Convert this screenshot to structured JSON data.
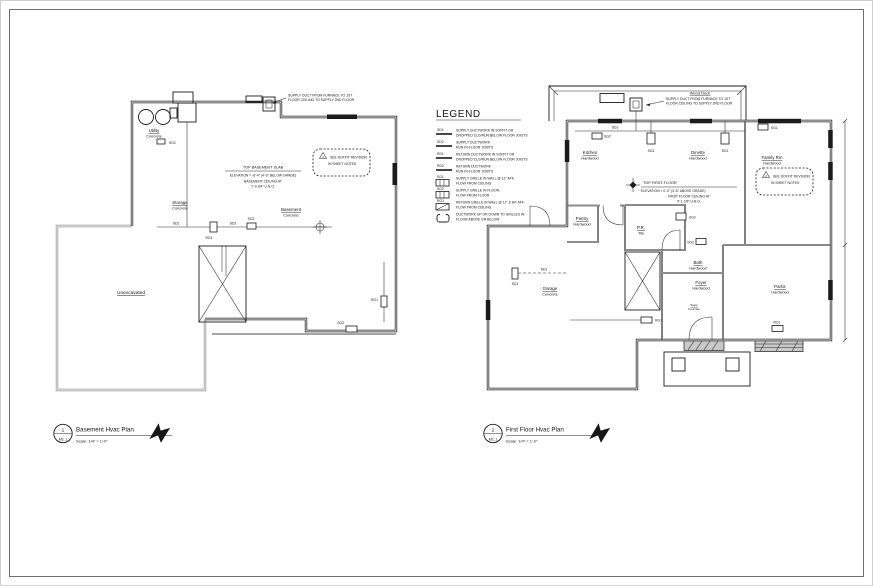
{
  "sheet": {
    "paper_color": "#ffffff",
    "line_color": "#1b1b1b",
    "gray_line_color": "#8f8f8f"
  },
  "legend": {
    "title": "LEGEND",
    "items": [
      {
        "tag": "SD1",
        "desc1": "SUPPLY DUCTWORK IN SOFFIT OR",
        "desc2": "DROPPED CLG/RUN BELOW FLOOR JOISTS"
      },
      {
        "tag": "SD2",
        "desc1": "SUPPLY DUCTWORK",
        "desc2": "RUN IN FLOOR JOISTS"
      },
      {
        "tag": "RD1",
        "desc1": "RETURN DUCTWORK IN SOFFIT OR",
        "desc2": "DROPPED CLG/RUN BELOW FLOOR JOISTS"
      },
      {
        "tag": "RD2",
        "desc1": "RETURN DUCTWORK",
        "desc2": "RUN IN FLOOR JOISTS"
      },
      {
        "tag": "SG1",
        "desc1": "SUPPLY GRILLE IN WALL @ 12\" AFF,",
        "desc2": "FLOW FROM CEILING"
      },
      {
        "tag": "SG2",
        "desc1": "SUPPLY GRILLE IN FLOOR,",
        "desc2": "FLOW FROM FLOOR"
      },
      {
        "tag": "RG1",
        "desc1": "RETURN GRILLE IN WALL @ 12\" & 84\" AFF,",
        "desc2": "FLOW FROM CEILING"
      },
      {
        "tag": "",
        "desc1": "DUCTWORK UP OR DOWN TO GRILLES IN",
        "desc2": "FLOOR ABOVE OR BELOW"
      }
    ]
  },
  "basement_plan": {
    "callout": {
      "number": "1",
      "sheet": "M1.1"
    },
    "title": "Basement Hvac Plan",
    "scale": "Scale: 1/4\" = 1'-0\"",
    "rooms": {
      "utility": {
        "name": "Utility",
        "floor": "Concrete"
      },
      "storage": {
        "name": "Storage",
        "floor": "Concrete"
      },
      "basement": {
        "name": "Basement",
        "floor": "Concrete"
      },
      "unexcavated": {
        "name": "Unexcavated"
      }
    },
    "supply_note": {
      "line1": "SUPPLY DUCT FROM FURNACE TO 1ST",
      "line2": "FLOOR CEILING TO SUPPLY 2ND FLOOR"
    },
    "elevation_note": {
      "line1": "TOP BASEMENT SLAB",
      "line2": "ELEVATION = -8'-4\" (4'-0\" BELOW GRADE)",
      "line3": "BASEMENT CEILING AT",
      "line4": "7'-9 3/4\" U.N.O."
    },
    "revision_cloud": {
      "delta": "2",
      "line1": "SEE SOFFIT REVISION",
      "line2": "IN SHEET NOTES"
    },
    "tags": [
      "SG2",
      "SD1",
      "RG1",
      "SD2",
      "SG2",
      "RG1",
      "SG2"
    ]
  },
  "first_floor_plan": {
    "callout": {
      "number": "2",
      "sheet": "M1.1"
    },
    "title": "First Floor Hvac Plan",
    "scale": "Scale: 1/4\" = 1'-0\"",
    "deck_label": "Wood Deck",
    "rooms": {
      "kitchen": {
        "name": "Kitchen",
        "floor": "Hardwood"
      },
      "dinette": {
        "name": "Dinette",
        "floor": "Hardwood"
      },
      "family": {
        "name": "Family Rm",
        "floor": "Hardwood"
      },
      "pantry": {
        "name": "Pantry",
        "floor": "Hardwood"
      },
      "pr": {
        "name": "P.R.",
        "floor": "Tile"
      },
      "bath": {
        "name": "Bath",
        "floor": "Hardwood"
      },
      "foyer": {
        "name": "Foyer",
        "floor": "Hardwood"
      },
      "parlor": {
        "name": "Parlor",
        "floor": "Hardwood"
      },
      "garage": {
        "name": "Garage",
        "floor": "Concrete"
      },
      "stoop": {
        "name": "Stoop",
        "floor": "Concrete"
      }
    },
    "supply_note": {
      "line1": "SUPPLY DUCT FROM FURNACE TO 1ST",
      "line2": "FLOOR CEILING TO SUPPLY 2ND FLOOR"
    },
    "elevation_note": {
      "line1": "TOP FIRST FLOOR",
      "line2": "ELEVATION = 0'-0\" (4'-6\" ABOVE GRADE)",
      "line3": "FIRST FLOOR CEILING AT",
      "line4": "9'-1 1/8\" U.N.O."
    },
    "revision_cloud": {
      "delta": "2",
      "line1": "SEE SOFFIT REVISION",
      "line2": "IN SHEET NOTES"
    },
    "tags": [
      "SG2",
      "SD1",
      "SG1",
      "SG1",
      "SG1",
      "SG2",
      "SG2",
      "SG1",
      "SD1",
      "RG1",
      "RG1"
    ]
  }
}
